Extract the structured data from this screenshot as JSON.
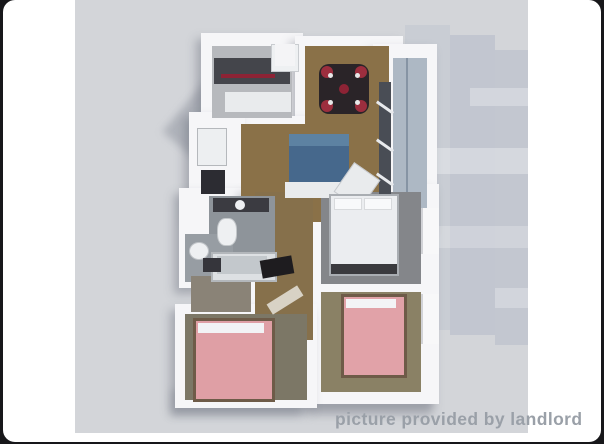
{
  "frame": {
    "outer_background": "#17171a",
    "card_background": "#ffffff"
  },
  "photo": {
    "background": "#d3d5d9",
    "caption": "picture provided by landlord",
    "caption_color": "#9aa0a8"
  },
  "floorplan": {
    "wall_color": "#f6f6f8",
    "wood_floor_color": "#8a7148",
    "kitchen_floor_color": "#b7b9bd",
    "bath_tile_color": "#8e949a",
    "bedroom1_floor_color": "#84868a",
    "bedroom2_floor_color": "#8a8165",
    "bedroom3_floor_color": "#7c7766",
    "closet_floor_color": "#8a8377",
    "balcony_glass_color": "#adb8c4",
    "window_panel_color": "#494d55",
    "sofa_color": "#46688c",
    "counter_color": "#44454b",
    "accent_red": "#8d2335",
    "dining_table_color": "#2a2428",
    "dining_chair_red": "#9c2e3e",
    "bed_pink": "#e1a2a8",
    "bed_white": "#ebedf0",
    "bed_frame_tan": "#6e5b48",
    "bed_headboard_dark": "#3a3a3e"
  }
}
